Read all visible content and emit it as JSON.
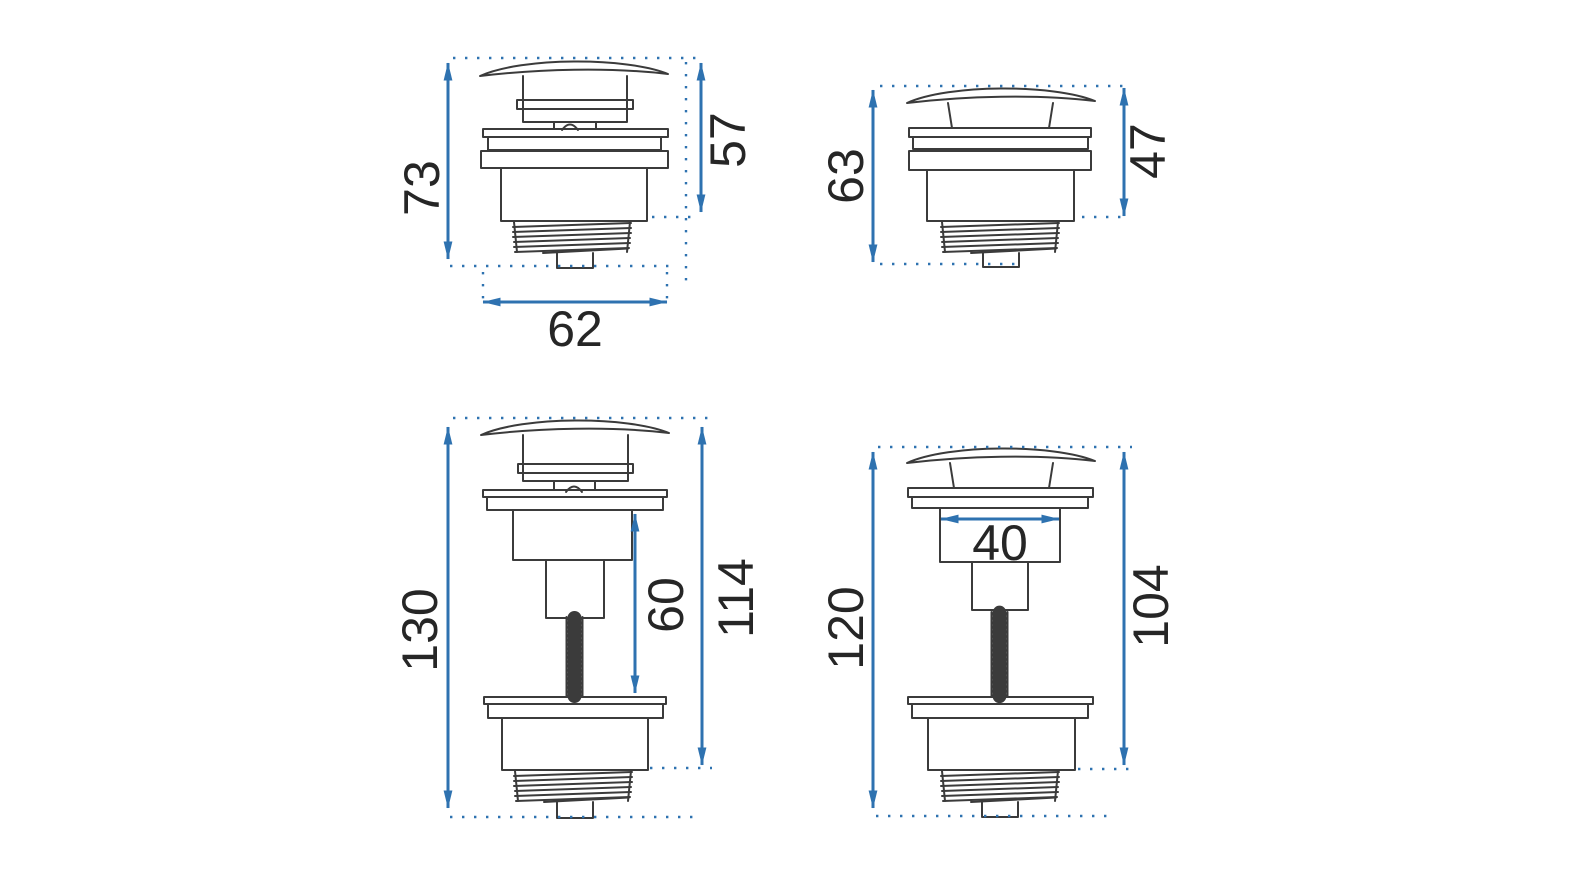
{
  "title": "drain-valve-dimension-drawing",
  "colors": {
    "dimension_blue": "#2e72b0",
    "outline_dark": "#3b3b3b",
    "label_dark": "#262626",
    "background": "#ffffff"
  },
  "drawings": {
    "top_left": {
      "name": "compact click-clack valve, cap raised",
      "dims": {
        "total_height": "73",
        "upper_height": "57",
        "width": "62"
      }
    },
    "top_right": {
      "name": "compact click-clack valve, cap closed",
      "dims": {
        "total_height": "63",
        "upper_height": "47"
      }
    },
    "bottom_left": {
      "name": "tall valve with threaded stem, cap raised",
      "dims": {
        "total_height": "130",
        "stem_length": "60",
        "upper_height": "114"
      }
    },
    "bottom_right": {
      "name": "tall valve with threaded stem, cap closed",
      "dims": {
        "total_height": "120",
        "neck_width": "40",
        "upper_height": "104"
      }
    }
  }
}
